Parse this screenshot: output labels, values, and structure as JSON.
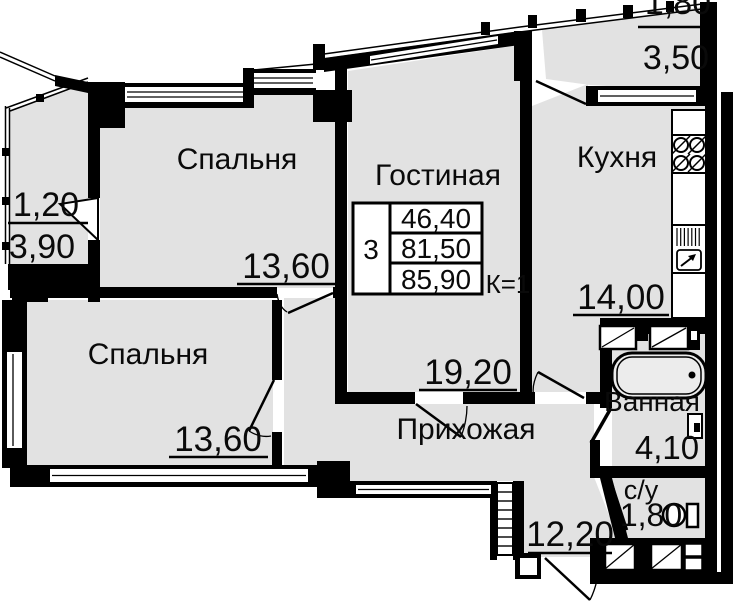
{
  "title": "Apartment floor plan 3-room",
  "colors": {
    "walls": "#000000",
    "room_fill": "#e2e2e2",
    "background": "#ffffff"
  },
  "rooms": {
    "bedroom1": {
      "label": "Спальня",
      "area": "13,60"
    },
    "bedroom2": {
      "label": "Спальня",
      "area": "13,60"
    },
    "living": {
      "label": "Гостиная",
      "area": "19,20"
    },
    "kitchen": {
      "label": "Кухня",
      "area": "14,00"
    },
    "hallway": {
      "label": "Прихожая",
      "area": "12,20"
    },
    "bathroom": {
      "label": "Ванная",
      "area": "4,10"
    },
    "wc": {
      "label": "с/у",
      "area": "1,80"
    },
    "balcony_left": {
      "area_upper": "1,20",
      "area_lower": "3,90"
    },
    "balcony_top": {
      "area_upper": "1,80",
      "area_lower": "3,50"
    }
  },
  "info_table": {
    "rooms_count": "3",
    "living_area": "46,40",
    "area_no_balcony": "81,50",
    "total_area": "85,90",
    "coefficient": "К=1"
  }
}
